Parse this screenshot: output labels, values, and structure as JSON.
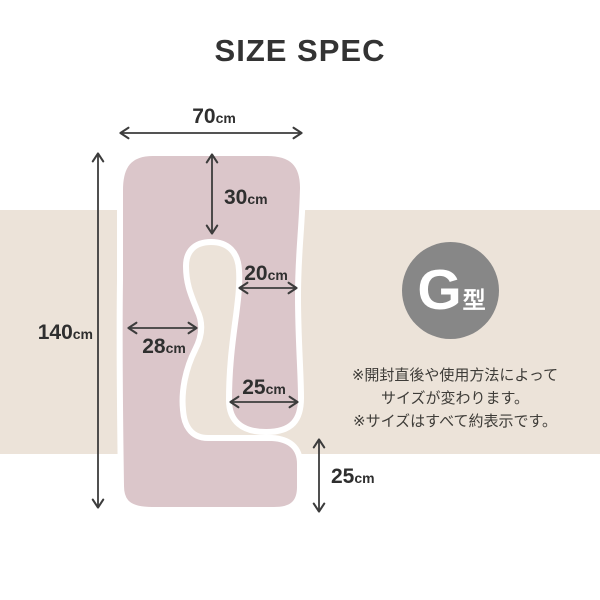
{
  "title": "SIZE SPEC",
  "badge": {
    "letter": "G",
    "type_suffix": "型"
  },
  "notes": {
    "line1": "※開封直後や使用方法によって",
    "line2": "サイズが変わります。",
    "line3": "※サイズはすべて約表示です。"
  },
  "dimensions": {
    "top_width": {
      "value": "70",
      "unit": "cm"
    },
    "head_depth": {
      "value": "30",
      "unit": "cm"
    },
    "arm_width": {
      "value": "20",
      "unit": "cm"
    },
    "body_width": {
      "value": "28",
      "unit": "cm"
    },
    "arm_end_width": {
      "value": "25",
      "unit": "cm"
    },
    "total_height": {
      "value": "140",
      "unit": "cm"
    },
    "tail_height": {
      "value": "25",
      "unit": "cm"
    }
  },
  "colors": {
    "pillow": "#dbc6ca",
    "outline": "#ffffff",
    "band": "#ece3d9",
    "badge_circle": "#878787",
    "arrow": "#3c3c3c",
    "text": "#333333"
  }
}
